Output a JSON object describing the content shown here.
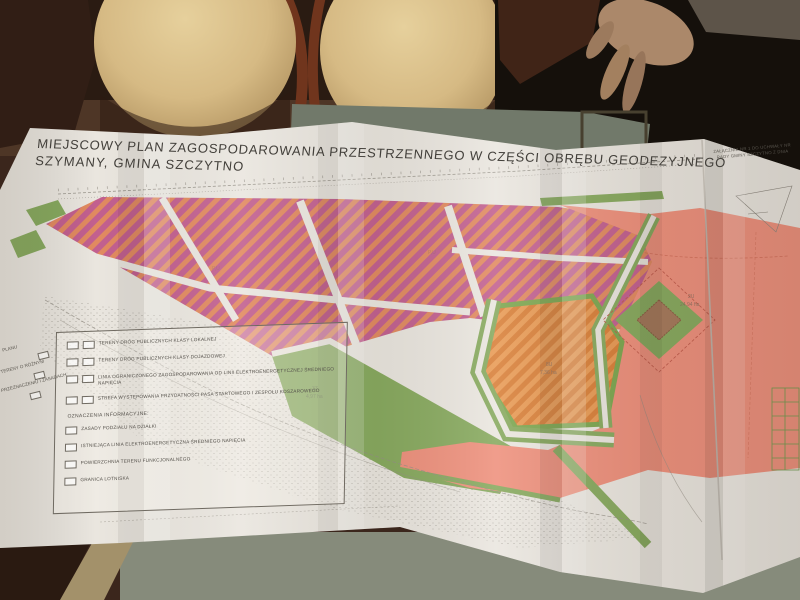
{
  "map": {
    "title_line1": "MIEJSCOWY PLAN ZAGOSPODAROWANIA PRZESTRZENNEGO W CZĘŚCI OBRĘBU GEODEZYJNEGO",
    "title_line2": "SZYMANY, GMINA SZCZYTNO",
    "attachment": {
      "line1": "ZAŁĄCZNIK NR 1 DO UCHWAŁY NR",
      "line2": "RADY GMINY SZCZYTNO Z DNIA"
    },
    "legend": {
      "zoning_items": [
        {
          "label": "TERENY DRÓG PUBLICZNYCH KLASY LOKALNEJ"
        },
        {
          "label": "TERENY DRÓG PUBLICZNYCH KLASY DOJAZDOWEJ"
        },
        {
          "label": "LINIA OGRANICZONEGO ZAGOSPODAROWANIA OD LINII ELEKTROENERGETYCZNEJ ŚREDNIEGO NAPIĘCIA"
        },
        {
          "label": "STREFA WYSTĘPOWANIA PRZYDATNOŚCI PASA STARTOWEGO I ZESPOŁU KOSZAROWEGO"
        }
      ],
      "info_heading": "OZNACZENIA INFORMACYJNE:",
      "info_items": [
        {
          "label": "ZASADY PODZIAŁU NA DZIAŁKI"
        },
        {
          "label": "ISTNIEJĄCA LINIA ELEKTROENERGETYCZNA ŚREDNIEGO NAPIĘCIA"
        },
        {
          "label": "POWIERZCHNIA TERENU FUNKCJONALNEGO"
        },
        {
          "label": "GRANICA LOTNISKA"
        }
      ],
      "edge_fragment1": "PLANU",
      "edge_fragment2": "TERENY O RÓŻNYM",
      "edge_fragment3": "PRZEZNACZENIU I ZASADACH"
    },
    "area_labels": {
      "pink_code_1": "P,U",
      "pink_code_2": "P,U",
      "orange_code": "8U",
      "orange_area": "7,36 ha",
      "salmon_code": "2U",
      "salmon_area": "24,94 ha",
      "green_code": "3Z",
      "green_area": "4,97 ha"
    },
    "colors": {
      "pink_stripe_a": "#c2608f",
      "pink_stripe_b": "#e18a60",
      "orange_stripe_a": "#e89a54",
      "orange_stripe_b": "#d87f38",
      "salmon": "#ee907c",
      "green": "#87a95e",
      "paper": "#eae6df"
    }
  }
}
